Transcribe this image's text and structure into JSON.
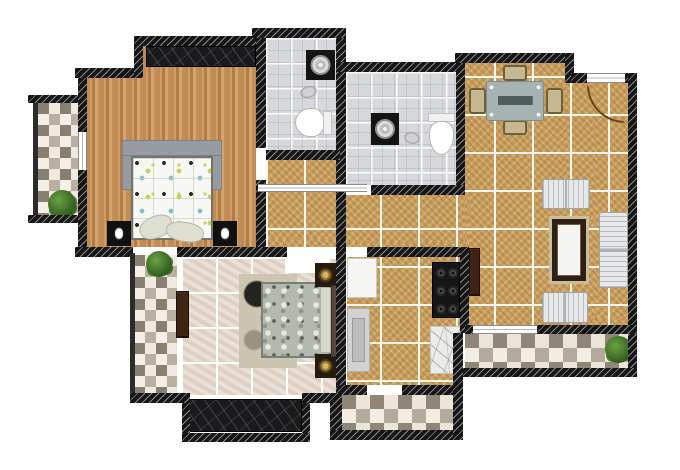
{
  "plan": {
    "type": "residential apartment floor plan, top-down rendered view, no text labels",
    "canvas": {
      "width": 680,
      "height": 470,
      "background": "#ffffff"
    },
    "colors": {
      "wall": "#151515",
      "wall_hatch": "#ffffff",
      "wood_floor": "#c3905a",
      "gold_tile": "#c79e5d",
      "bath_tile": "#d6d8db",
      "bedroom2_tile": "#e7dbd1",
      "balcony_checker_dark": "#8f8678",
      "balcony_checker_light": "#f2ede3",
      "plant_green": "#3f7a2d",
      "door_arc_brown": "#6b431c",
      "sofa_gray": "#e6e8ea",
      "dining_table_gray": "#a7b3b3",
      "stove_black": "#161616",
      "bed1_dot_yellow": "#c6cf52",
      "bed1_dot_blue": "#7cc0cc",
      "rug_olive": "#89914b"
    },
    "rooms": {
      "bedroom1": {
        "label": "bedroom with wooden floor, double bed and dark wardrobe strip"
      },
      "balcony_top_left": {
        "label": "small balcony with checker tiles and plant"
      },
      "bathroom1": {
        "label": "bathroom with sink, drain and toilet"
      },
      "bathroom2": {
        "label": "second bathroom with sink, drain and toilet"
      },
      "living_dining": {
        "label": "open living and dining area with gold tiles"
      },
      "kitchen": {
        "label": "kitchen with stove, sink and counters"
      },
      "bedroom2": {
        "label": "second bedroom with tiled floor, bed, rug and wardrobe niche"
      },
      "corridor_balcony": {
        "label": "narrow checker-tiled passage balcony with plant"
      },
      "utility_balcony": {
        "label": "utility balcony below kitchen"
      },
      "balcony_bottom_right": {
        "label": "rear balcony strip with plant"
      }
    },
    "furniture": {
      "bed1": {
        "label": "double bed with white dotted quilt and pillows"
      },
      "headboard1": {
        "label": "gray headboard panel"
      },
      "nightstand": {
        "label": "nightstand with lamp"
      },
      "wardrobe1": {
        "label": "dark wardrobe strip"
      },
      "sink": {
        "label": "washbasin on dark counter"
      },
      "toilet": {
        "label": "toilet"
      },
      "dining_table": {
        "label": "dining table with four chairs"
      },
      "entrance_door": {
        "label": "entrance door with swing arc"
      },
      "loveseat": {
        "label": "two-seat sofa"
      },
      "sofa3": {
        "label": "three-seat sofa"
      },
      "center_table": {
        "label": "ornate center table"
      },
      "tall_cabinet": {
        "label": "tall dark-brown cabinet"
      },
      "kitchen_counter": {
        "label": "kitchen counter"
      },
      "kitchen_sink": {
        "label": "kitchen sink counter"
      },
      "stove": {
        "label": "six-burner stove"
      },
      "bed2": {
        "label": "double bed with floral gray cover"
      },
      "rug2": {
        "label": "circle-pattern rug"
      },
      "wardrobe2": {
        "label": "dark wardrobe in niche"
      },
      "plant": {
        "label": "potted green plant"
      },
      "window": {
        "label": "window / opening"
      }
    }
  }
}
